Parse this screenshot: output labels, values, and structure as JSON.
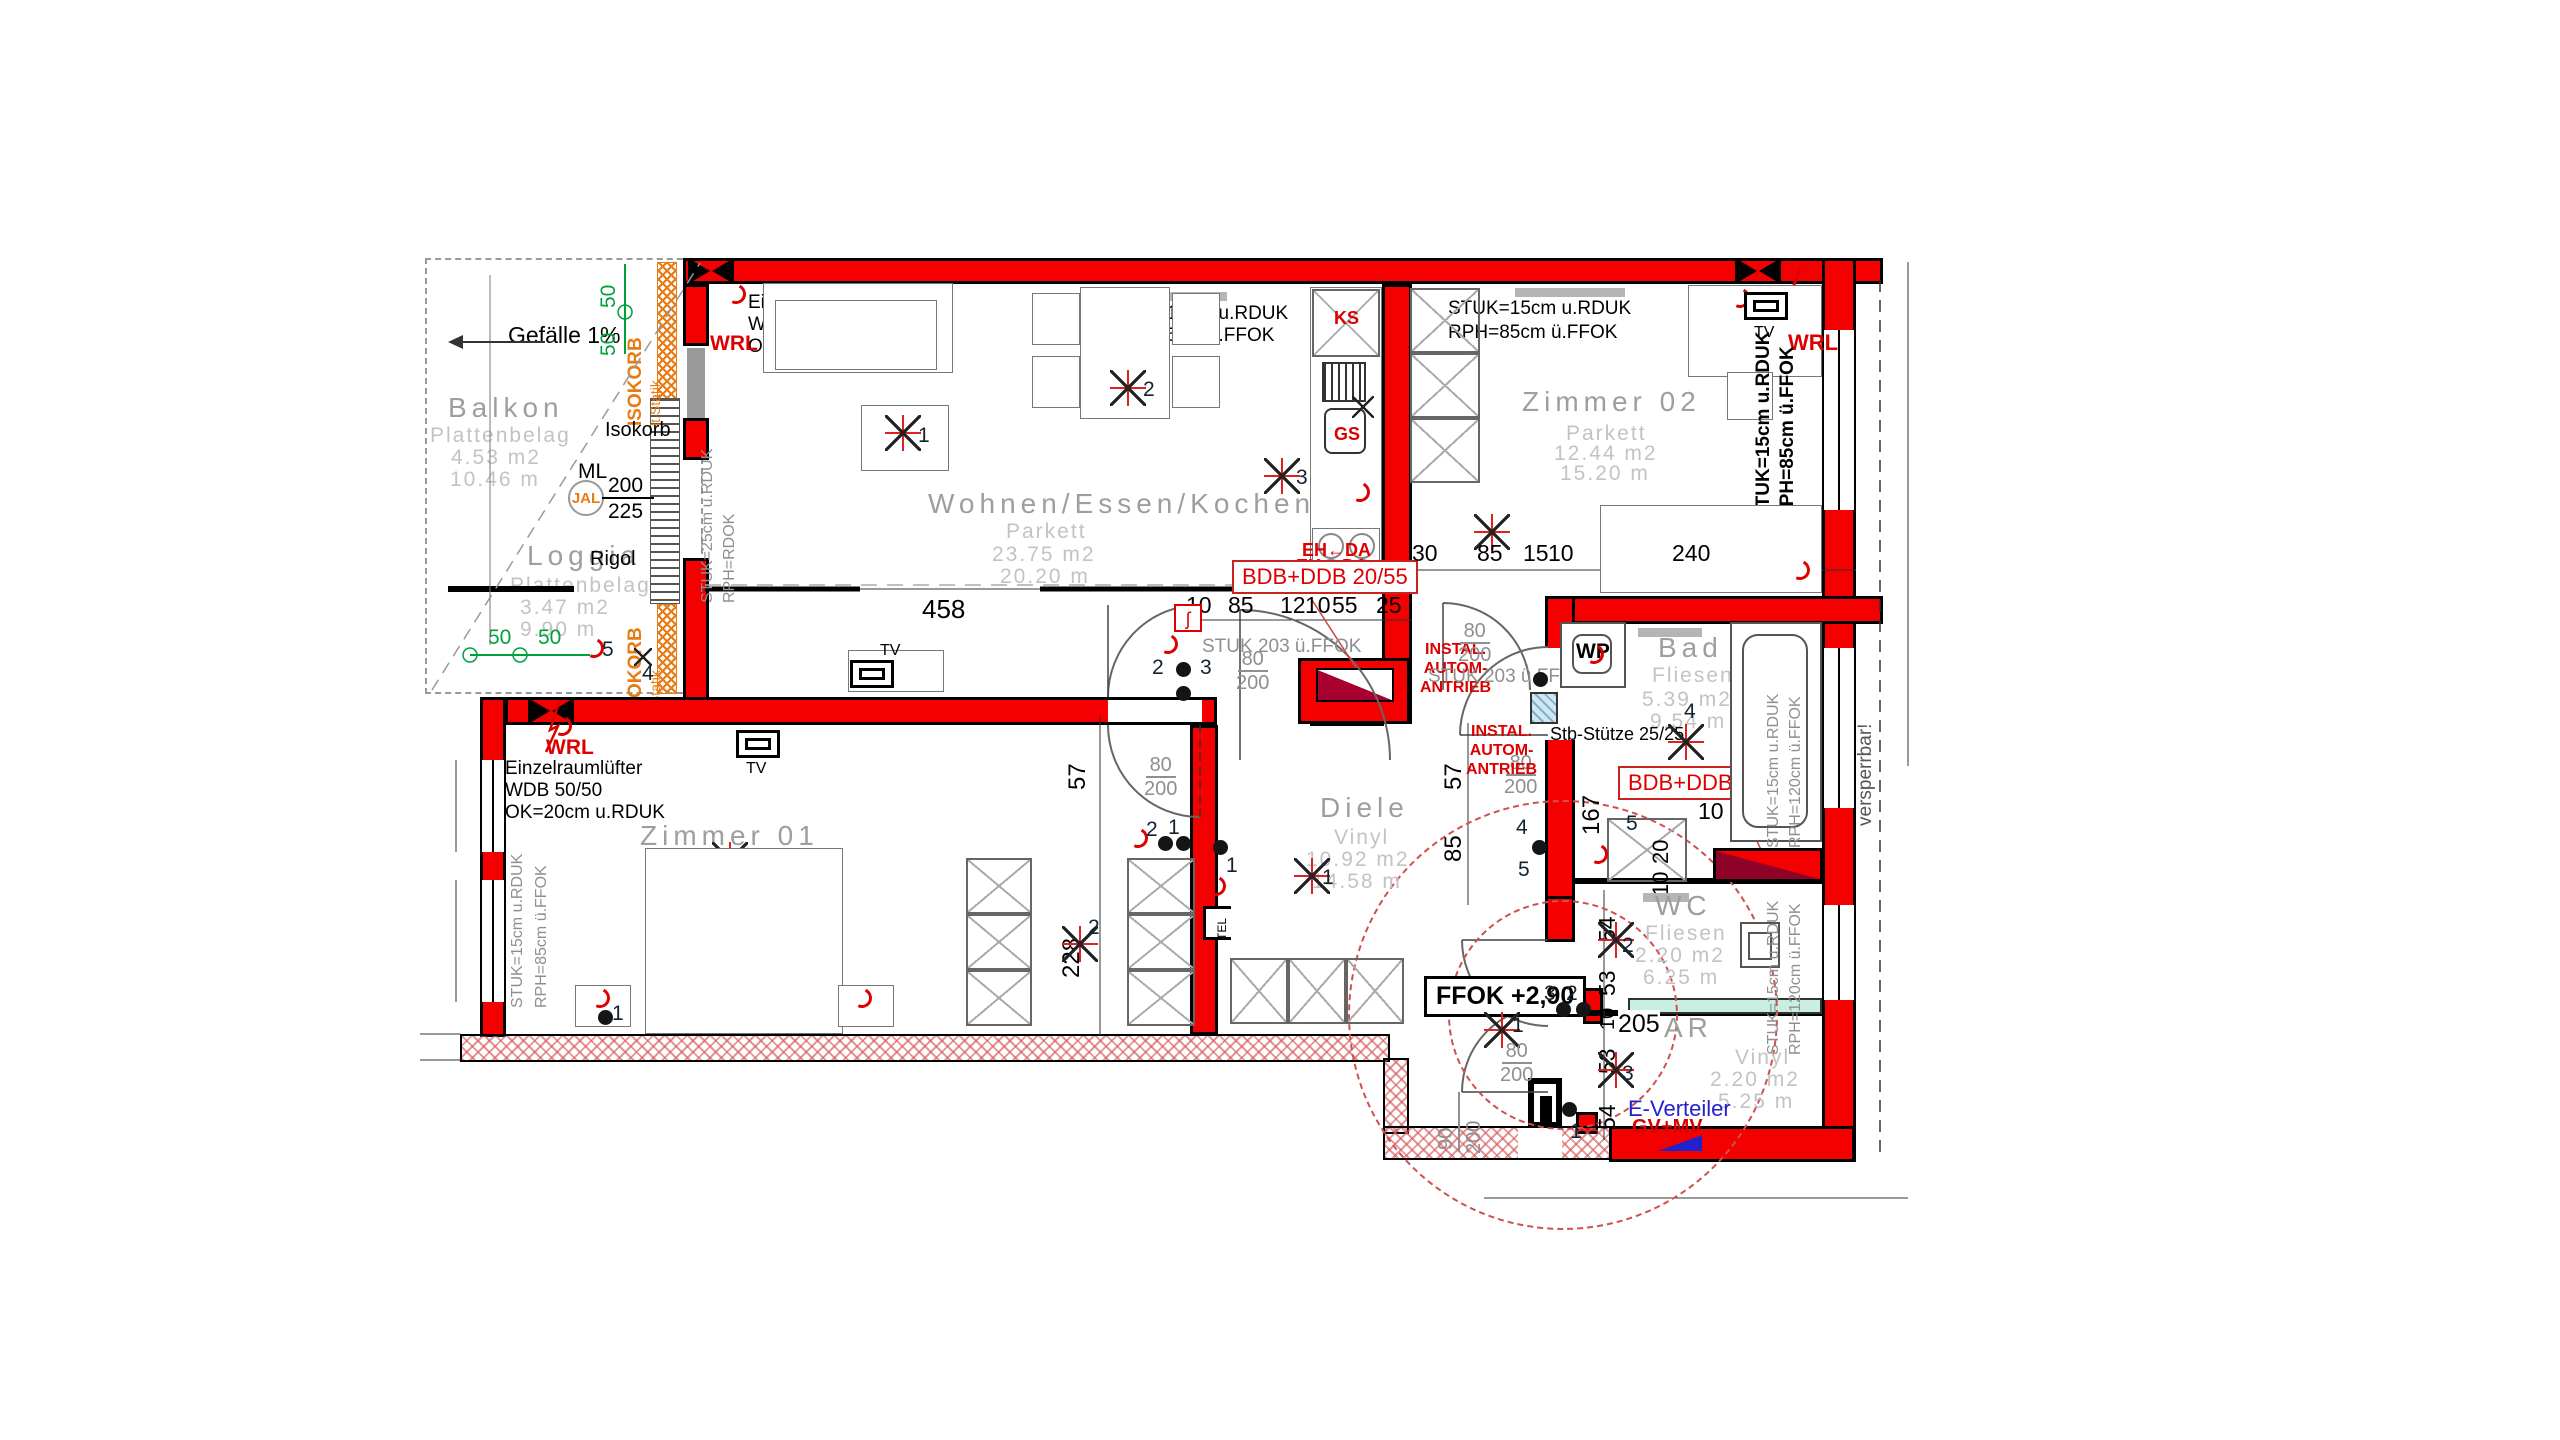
{
  "colors": {
    "wall_red": "#f40000",
    "annot_red": "#dd0000",
    "crimson": "#a8012f",
    "dim_green": "#00a03c",
    "orange": "#e87b14",
    "gray_label": "#9e9e9e",
    "gray_light": "#c3c3c3",
    "blue": "#2222cc",
    "cyan": "#c8efe2",
    "glass_blue": "#cfe7f3"
  },
  "rooms": [
    {
      "name": "Balkon",
      "floor": "Plattenbelag",
      "area": "4.53 m2",
      "perimeter": "10.46 m"
    },
    {
      "name": "Loggia",
      "floor": "Plattenbelag",
      "area": "3.47 m2",
      "perimeter": "9.90 m"
    },
    {
      "name": "Wohnen/Essen/Kochen",
      "floor": "Parkett",
      "area": "23.75 m2",
      "perimeter": "20.20 m"
    },
    {
      "name": "Zimmer 02",
      "floor": "Parkett",
      "area": "12.44 m2",
      "perimeter": "15.20 m"
    },
    {
      "name": "Zimmer 01",
      "floor": "Parkett",
      "area": "17.96 m2",
      "perimeter": "18.39 m"
    },
    {
      "name": "Diele",
      "floor": "Vinyl",
      "area": "10.92 m2",
      "perimeter": "14.58 m"
    },
    {
      "name": "Bad",
      "floor": "Fliesen",
      "area": "5.39 m2",
      "perimeter": "9.54 m"
    },
    {
      "name": "WC",
      "floor": "Fliesen",
      "area": "2.20 m2",
      "perimeter": "6.25 m"
    },
    {
      "name": "AR",
      "floor": "Vinyl",
      "area": "2.20 m2",
      "perimeter": "5.25 m"
    }
  ],
  "labels": {
    "gefaelle": "Gefälle 1%",
    "isokorb_big": "ISOKORB",
    "lt_statik": "lt.Statik",
    "isokorb_small": "Isokorb",
    "ml": "ML",
    "ml_over": "200",
    "ml_under": "225",
    "jal": "JAL",
    "rigol": "Rigol",
    "wrl": "WRL",
    "luefter": "Einzelraumlüfter",
    "wdb": "WDB 50/50",
    "ok20": "OK=20cm u.RDUK",
    "stuk15": "STUK=15cm u.RDUK",
    "stuk25": "STUK=25cm u.RDUK",
    "rph85": "RPH=85cm ü.FFOK",
    "rph120": "RPH=120cm ü.FFOK",
    "rph_rdok": "RPH=RDOK",
    "stuk203": "STUK 203 ü.FFOK",
    "bdb55": "BDB+DDB 20/55",
    "bdb90": "BDB+DDB 20/90",
    "ks": "KS",
    "gs": "GS",
    "eh": "EH",
    "da": "DA",
    "instal1": "INSTAL.",
    "instal2": "AUTOM-",
    "instal3": "ANTRIEB",
    "stb": "Stb-Stütze 25/25",
    "ffok": "FFOK +2,90",
    "everteiler": "E-Verteiler",
    "gvmv": "GV+MV",
    "versperrbar": "versperrbar!",
    "tv": "TV",
    "tel": "TEL",
    "wp": "WP",
    "jhook": "ʃ"
  },
  "dims": {
    "d458": "458",
    "d10": "10",
    "d85": "85",
    "d12": "12",
    "d55": "55",
    "d25": "25",
    "d30": "30",
    "d15": "15",
    "d240": "240",
    "d57": "57",
    "d228": "228",
    "d167": "167",
    "d205": "205",
    "d90": "90",
    "d20": "20",
    "d54": "54",
    "d53": "53",
    "d80": "80",
    "d200": "200",
    "d50": "50"
  },
  "marks": {
    "n1": "1",
    "n2": "2",
    "n3": "3",
    "n4": "4",
    "n5": "5"
  }
}
